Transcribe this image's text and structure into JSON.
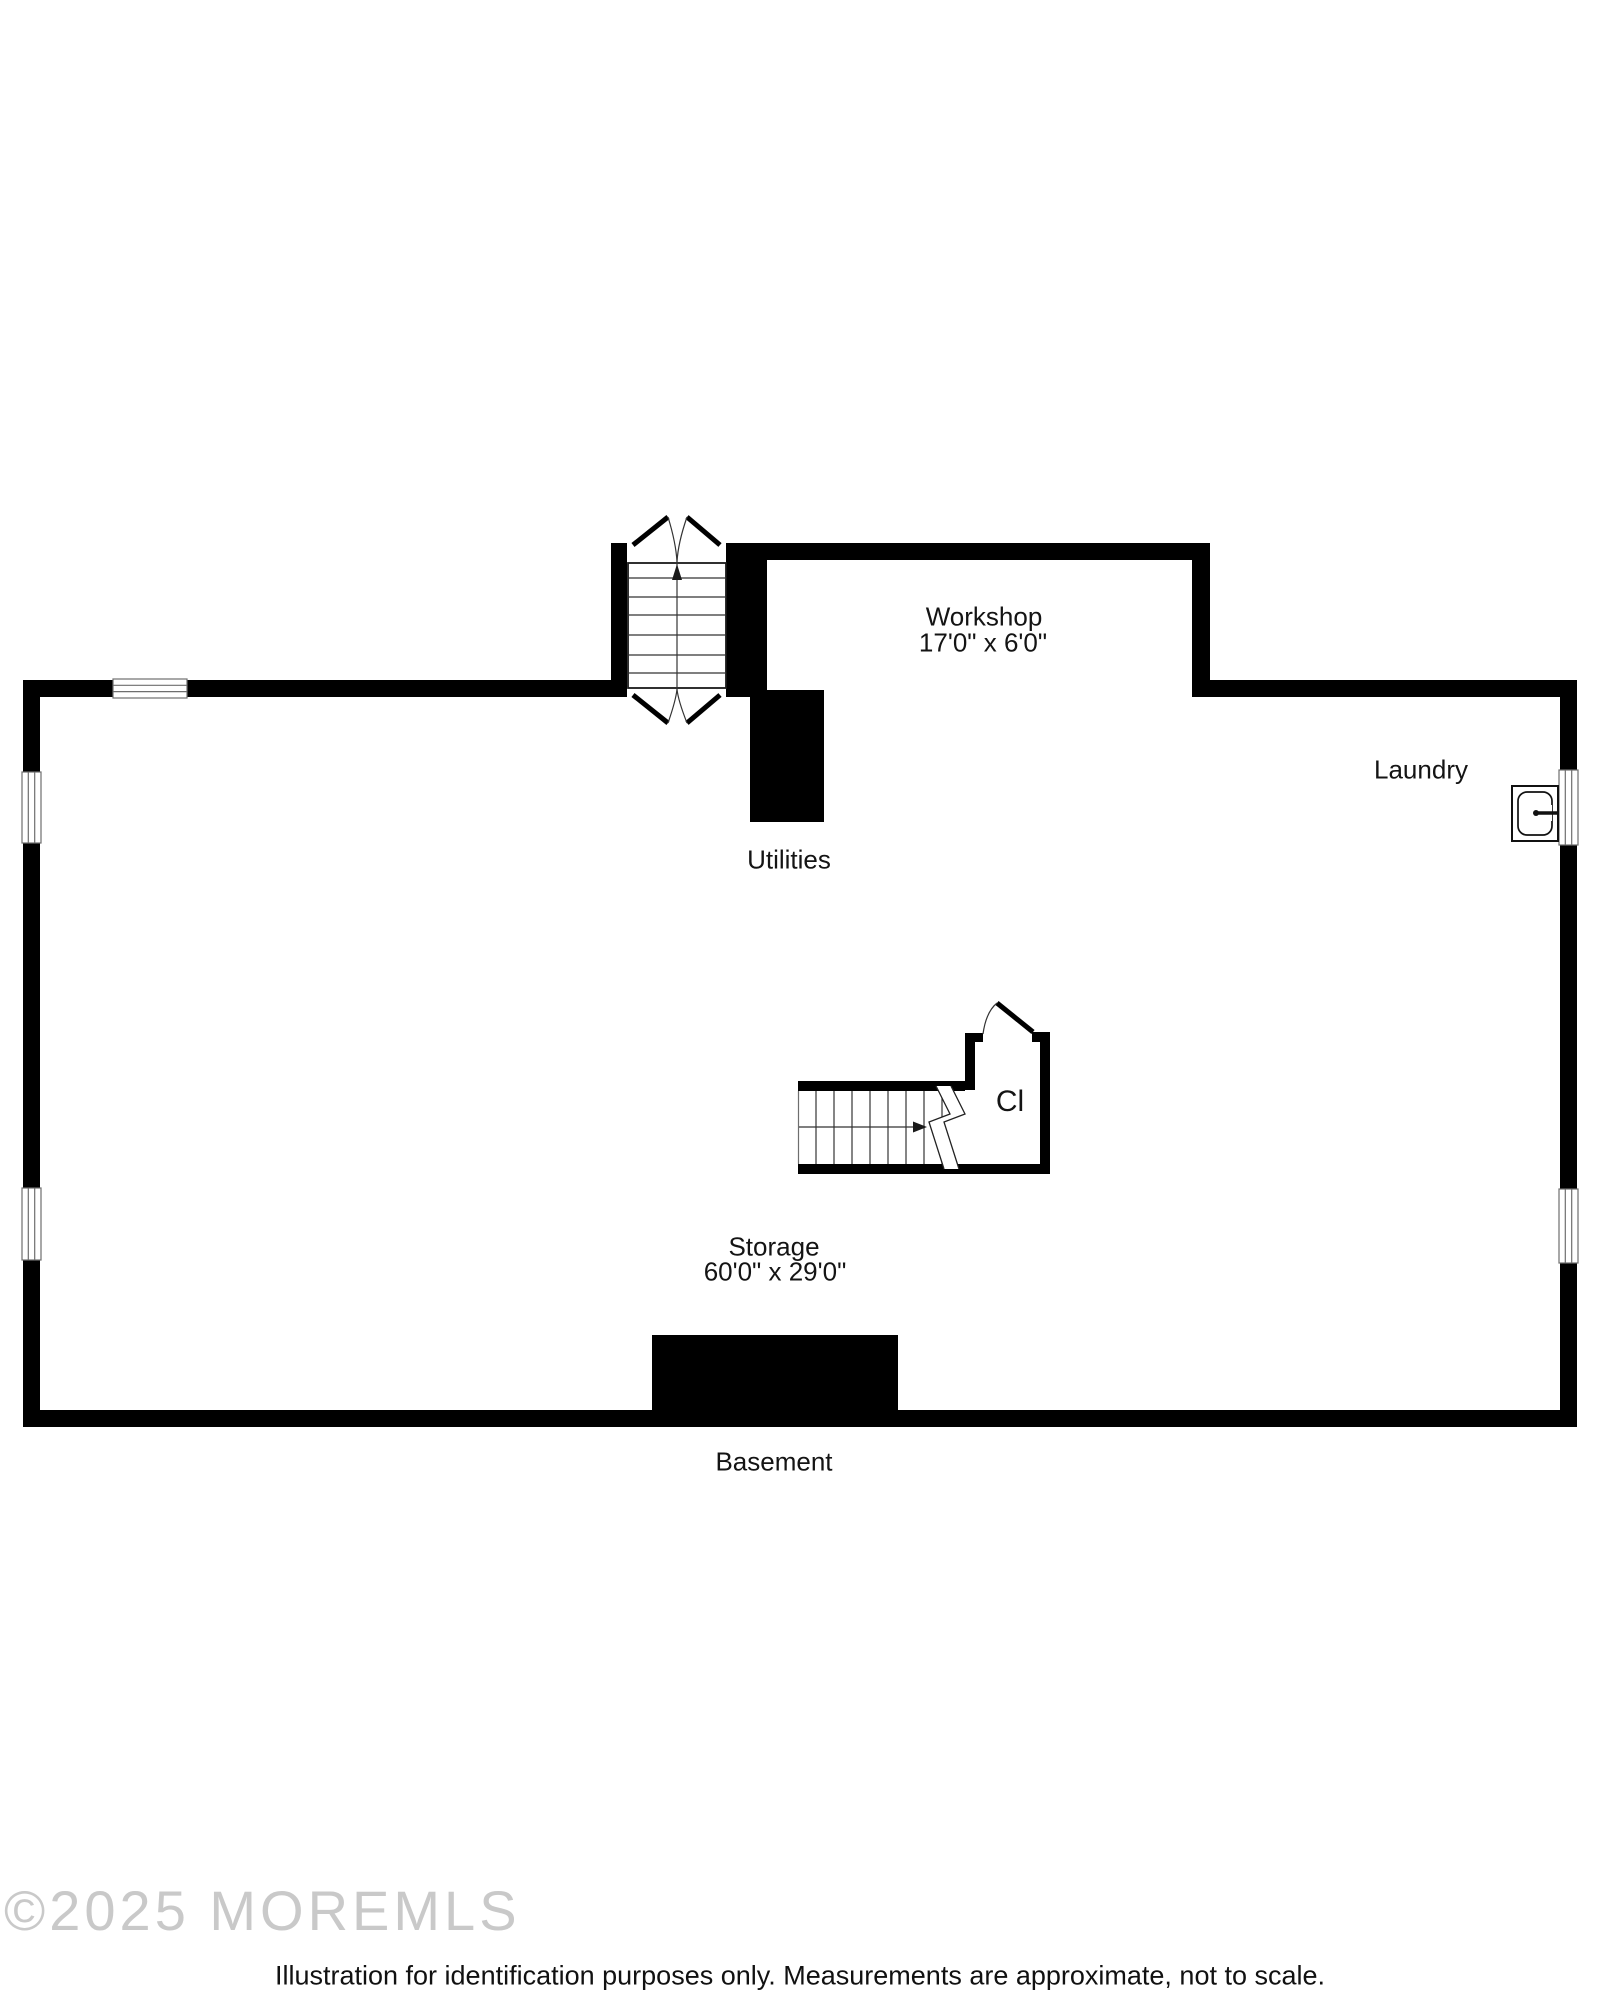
{
  "rooms": {
    "workshop": {
      "name": "Workshop",
      "dims": "17'0\" x 6'0\""
    },
    "laundry": {
      "name": "Laundry"
    },
    "utilities": {
      "name": "Utilities"
    },
    "closet": {
      "name": "Cl"
    },
    "storage": {
      "name": "Storage",
      "dims": "60'0\" x 29'0\""
    },
    "basement": {
      "name": "Basement"
    }
  },
  "footer": {
    "watermark": "©2025 MOREMLS",
    "disclaimer": "Illustration for identification purposes only. Measurements are approximate, not to scale."
  },
  "colors": {
    "wall": "#000000",
    "label_text": "#141414",
    "watermark": "#c9c9c9",
    "window_line": "#6e6e6e",
    "fixture_line": "#111111"
  }
}
